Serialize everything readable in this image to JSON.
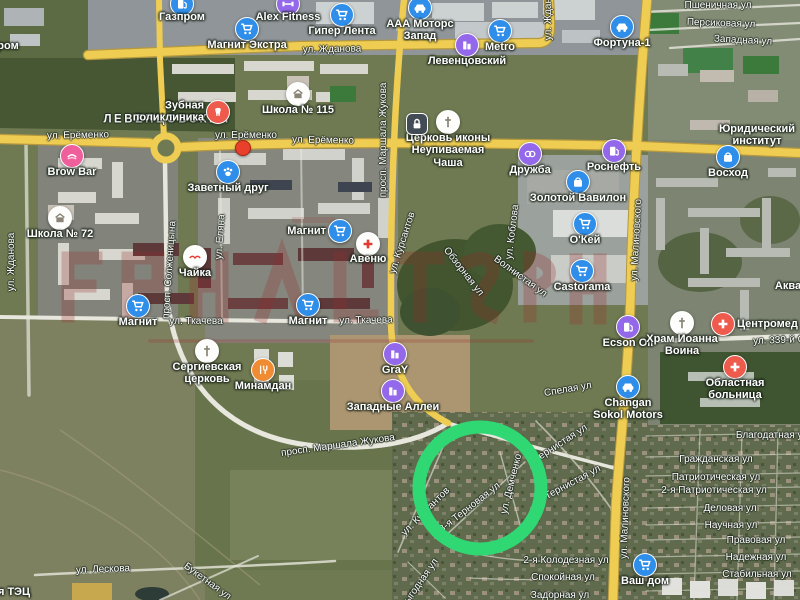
{
  "map": {
    "kind": "satellite",
    "district": "ЛЕВЕНЦОВСКИЙ",
    "annotation": {
      "shape": "circle",
      "cx": 480,
      "cy": 488,
      "r": 61,
      "stroke_width": 13,
      "color": "#2fd873"
    },
    "marker": {
      "x": 243,
      "y": 148,
      "color": "#e8402a"
    },
    "watermark": {
      "color": "#9b2a2a",
      "opacity": 0.26
    },
    "pois": [
      {
        "l": "Газпром",
        "i": "fuel",
        "c": "blue",
        "x": 182,
        "y": 4,
        "ly": 11
      },
      {
        "l": "Alex Fitness",
        "i": "fitness",
        "c": "purple",
        "x": 288,
        "y": 4,
        "ly": 11
      },
      {
        "l": "Гипер Лента",
        "i": "cart",
        "c": "blue",
        "x": 342,
        "y": 15,
        "ly": 25
      },
      {
        "l": "Магнит Экстра",
        "i": "cart",
        "c": "blue",
        "x": 247,
        "y": 29,
        "ly": 39
      },
      {
        "l": "ААА Моторс Запад",
        "i": "car",
        "c": "blue",
        "x": 420,
        "y": 8,
        "ly": 18,
        "lines": [
          "ААА Моторс",
          "Запад"
        ]
      },
      {
        "l": "Metro",
        "i": "cart",
        "c": "blue",
        "x": 500,
        "y": 31,
        "ly": 41
      },
      {
        "l": "Левенцовский",
        "i": "complex",
        "c": "purple",
        "x": 467,
        "y": 45,
        "ly": 55
      },
      {
        "l": "Фортуна-1",
        "i": "car",
        "c": "blue",
        "x": 622,
        "y": 27,
        "ly": 37
      },
      {
        "l": "Зубная поликлиника",
        "i": "tooth",
        "c": "coral",
        "x": 218,
        "y": 112,
        "ls": "left",
        "lines": [
          "Зубная",
          "поликлиника"
        ]
      },
      {
        "l": "Brow Bar",
        "i": "beauty",
        "c": "pink",
        "x": 72,
        "y": 156,
        "ly": 166
      },
      {
        "l": "Заветный друг",
        "i": "paw",
        "c": "blue",
        "x": 228,
        "y": 172,
        "ly": 182
      },
      {
        "l": "Школа № 115",
        "i": "school",
        "c": "white",
        "x": 298,
        "y": 94,
        "ly": 104
      },
      {
        "l": "Церковь иконы Неупиваемая Чаша",
        "i": "church",
        "c": "white",
        "x": 448,
        "y": 122,
        "ly": 132,
        "lines": [
          "Церковь иконы",
          "Неупиваемая",
          "Чаша"
        ]
      },
      {
        "l": "Дружба",
        "i": "cinema",
        "c": "purple",
        "x": 530,
        "y": 154,
        "ly": 164
      },
      {
        "l": "Роснефть",
        "i": "fuel",
        "c": "purple",
        "x": 614,
        "y": 151,
        "ly": 161
      },
      {
        "l": "Восход",
        "i": "bag",
        "c": "blue",
        "x": 728,
        "y": 157,
        "ly": 167
      },
      {
        "l": "Юридический институт",
        "i": "none",
        "x": 757,
        "y": 136,
        "ly": 123,
        "lines": [
          "Юридический",
          "институт"
        ]
      },
      {
        "l": "Школа № 72",
        "i": "school",
        "c": "white",
        "x": 60,
        "y": 218,
        "ly": 228
      },
      {
        "l": "Золотой Вавилон",
        "i": "bag",
        "c": "blue",
        "x": 578,
        "y": 182,
        "ly": 192
      },
      {
        "l": "О'Кей",
        "i": "cart",
        "c": "blue",
        "x": 585,
        "y": 224,
        "ly": 234
      },
      {
        "l": "Чайка",
        "i": "bird",
        "c": "white",
        "x": 195,
        "y": 257,
        "ly": 267
      },
      {
        "l": "Авеню",
        "i": "pharmacy",
        "c": "white",
        "x": 368,
        "y": 244,
        "ly": 253
      },
      {
        "l": "Магнит",
        "i": "cart",
        "c": "blue",
        "x": 340,
        "y": 231,
        "ls": "left"
      },
      {
        "l": "Castorama",
        "i": "cart",
        "c": "blue",
        "x": 582,
        "y": 271,
        "ly": 281
      },
      {
        "l": "Магнит",
        "i": "cart",
        "c": "blue",
        "x": 138,
        "y": 306,
        "ly": 316
      },
      {
        "l": "Магнит",
        "i": "cart",
        "c": "blue",
        "x": 308,
        "y": 305,
        "ly": 315
      },
      {
        "l": "Центромед",
        "i": "hospital",
        "c": "coral",
        "x": 723,
        "y": 324,
        "ls": "right"
      },
      {
        "l": "Ecson Oil",
        "i": "fuel",
        "c": "purple",
        "x": 628,
        "y": 327,
        "ly": 337
      },
      {
        "l": "Храм Иоанна Воина",
        "i": "church",
        "c": "white",
        "x": 682,
        "y": 323,
        "ly": 333,
        "lines": [
          "Храм Иоанна",
          "Воина"
        ]
      },
      {
        "l": "Сергиевская церковь",
        "i": "church",
        "c": "white",
        "x": 207,
        "y": 351,
        "ly": 361,
        "lines": [
          "Сергиевская",
          "церковь"
        ]
      },
      {
        "l": "Минамдан",
        "i": "food",
        "c": "orange",
        "x": 263,
        "y": 370,
        "ly": 380
      },
      {
        "l": "GraY",
        "i": "complex",
        "c": "purple",
        "x": 395,
        "y": 354,
        "ly": 364
      },
      {
        "l": "Западные Аллеи",
        "i": "complex",
        "c": "purple",
        "x": 393,
        "y": 391,
        "ly": 401
      },
      {
        "l": "Changan Sokol Motors",
        "i": "car",
        "c": "blue",
        "x": 628,
        "y": 387,
        "ly": 397,
        "lines": [
          "Changan",
          "Sokol Motors"
        ]
      },
      {
        "l": "Областная больница",
        "i": "hospital",
        "c": "coral",
        "x": 735,
        "y": 367,
        "ly": 377,
        "lines": [
          "Областная",
          "больница"
        ]
      },
      {
        "l": "Ваш дом",
        "i": "cart",
        "c": "blue",
        "x": 645,
        "y": 565,
        "ly": 575
      },
      {
        "l": "Аква",
        "i": "none",
        "x": 788,
        "y": 286,
        "ly": 280
      },
      {
        "l": "ром",
        "i": "none",
        "x": 8,
        "y": 46,
        "ly": 40
      },
      {
        "l": "я ТЭЦ",
        "i": "none",
        "x": 14,
        "y": 592,
        "ly": 586
      },
      {
        "l": "",
        "i": "lock",
        "c": "dark",
        "x": 417,
        "y": 124
      }
    ],
    "streets": [
      {
        "t": "ул. Жданова",
        "x": 332,
        "y": 50,
        "r": -1
      },
      {
        "t": "ул. Жданова",
        "x": 549,
        "y": 11,
        "r": -90
      },
      {
        "t": "ул. Жданова",
        "x": 12,
        "y": 262,
        "r": -90
      },
      {
        "t": "Пшеничная ул",
        "x": 718,
        "y": 6,
        "r": 0
      },
      {
        "t": "Персиковая ул",
        "x": 721,
        "y": 24,
        "r": 2
      },
      {
        "t": "Западная ул",
        "x": 743,
        "y": 41,
        "r": 3
      },
      {
        "t": "ул. Ерёменко",
        "x": 78,
        "y": 136,
        "r": -1
      },
      {
        "t": "ЛЕВЕНЦОВСКИЙ",
        "x": 167,
        "y": 120,
        "r": 0,
        "k": "district"
      },
      {
        "t": "ул. Ерёменко",
        "x": 246,
        "y": 136,
        "r": 0
      },
      {
        "t": "ул. Ерёменко",
        "x": 323,
        "y": 141,
        "r": 1
      },
      {
        "t": "просп. Маршала Жукова",
        "x": 384,
        "y": 140,
        "r": -90
      },
      {
        "t": "просп. Солженицына",
        "x": 170,
        "y": 270,
        "r": -86
      },
      {
        "t": "ул. Еляна",
        "x": 221,
        "y": 237,
        "r": -86
      },
      {
        "t": "ул. Курсантов",
        "x": 403,
        "y": 243,
        "r": -72
      },
      {
        "t": "ул. Ткачева",
        "x": 196,
        "y": 322,
        "r": 0
      },
      {
        "t": "ул. Ткачева",
        "x": 366,
        "y": 321,
        "r": -1
      },
      {
        "t": "ул. Малиновского",
        "x": 637,
        "y": 240,
        "r": -87
      },
      {
        "t": "ул. Малиновского",
        "x": 626,
        "y": 518,
        "r": -88
      },
      {
        "t": "ул. 339-й С",
        "x": 779,
        "y": 341,
        "r": -2
      },
      {
        "t": "Волнистая ул",
        "x": 520,
        "y": 277,
        "r": 36
      },
      {
        "t": "Обзорная ул",
        "x": 463,
        "y": 272,
        "r": 52
      },
      {
        "t": "ул. Коблова",
        "x": 513,
        "y": 232,
        "r": -83
      },
      {
        "t": "просп. Маршала Жукова",
        "x": 338,
        "y": 446,
        "r": -8
      },
      {
        "t": "Спелая ул",
        "x": 568,
        "y": 390,
        "r": -10
      },
      {
        "t": "Тернистая ул",
        "x": 561,
        "y": 444,
        "r": -33
      },
      {
        "t": "Тернистая ул",
        "x": 573,
        "y": 483,
        "r": -28
      },
      {
        "t": "3-я Терновая ул",
        "x": 470,
        "y": 508,
        "r": -38
      },
      {
        "t": "ул. Демченко",
        "x": 512,
        "y": 484,
        "r": -76
      },
      {
        "t": "ул. Курсантов",
        "x": 426,
        "y": 512,
        "r": -45
      },
      {
        "t": "Благодатная ул",
        "x": 772,
        "y": 436,
        "r": 0
      },
      {
        "t": "Гражданская ул",
        "x": 716,
        "y": 460,
        "r": 0
      },
      {
        "t": "Патриотическая ул",
        "x": 716,
        "y": 478,
        "r": 0
      },
      {
        "t": "2-я Патриотическая ул",
        "x": 714,
        "y": 491,
        "r": 0
      },
      {
        "t": "Деловая ул",
        "x": 730,
        "y": 509,
        "r": 0
      },
      {
        "t": "Научная ул",
        "x": 731,
        "y": 526,
        "r": 0
      },
      {
        "t": "Правовая ул",
        "x": 756,
        "y": 541,
        "r": 0
      },
      {
        "t": "Надежная ул",
        "x": 756,
        "y": 558,
        "r": 0
      },
      {
        "t": "Стабильная ул",
        "x": 757,
        "y": 575,
        "r": 0
      },
      {
        "t": "2-я Колодезная ул",
        "x": 566,
        "y": 561,
        "r": 0
      },
      {
        "t": "Спокойная ул",
        "x": 563,
        "y": 578,
        "r": 0
      },
      {
        "t": "Задорная ул",
        "x": 560,
        "y": 596,
        "r": 0
      },
      {
        "t": "ул. Лескова",
        "x": 103,
        "y": 570,
        "r": -2
      },
      {
        "t": "Букетная ул",
        "x": 207,
        "y": 582,
        "r": 36
      },
      {
        "t": "Выгодная ул",
        "x": 420,
        "y": 584,
        "r": -55
      }
    ]
  }
}
